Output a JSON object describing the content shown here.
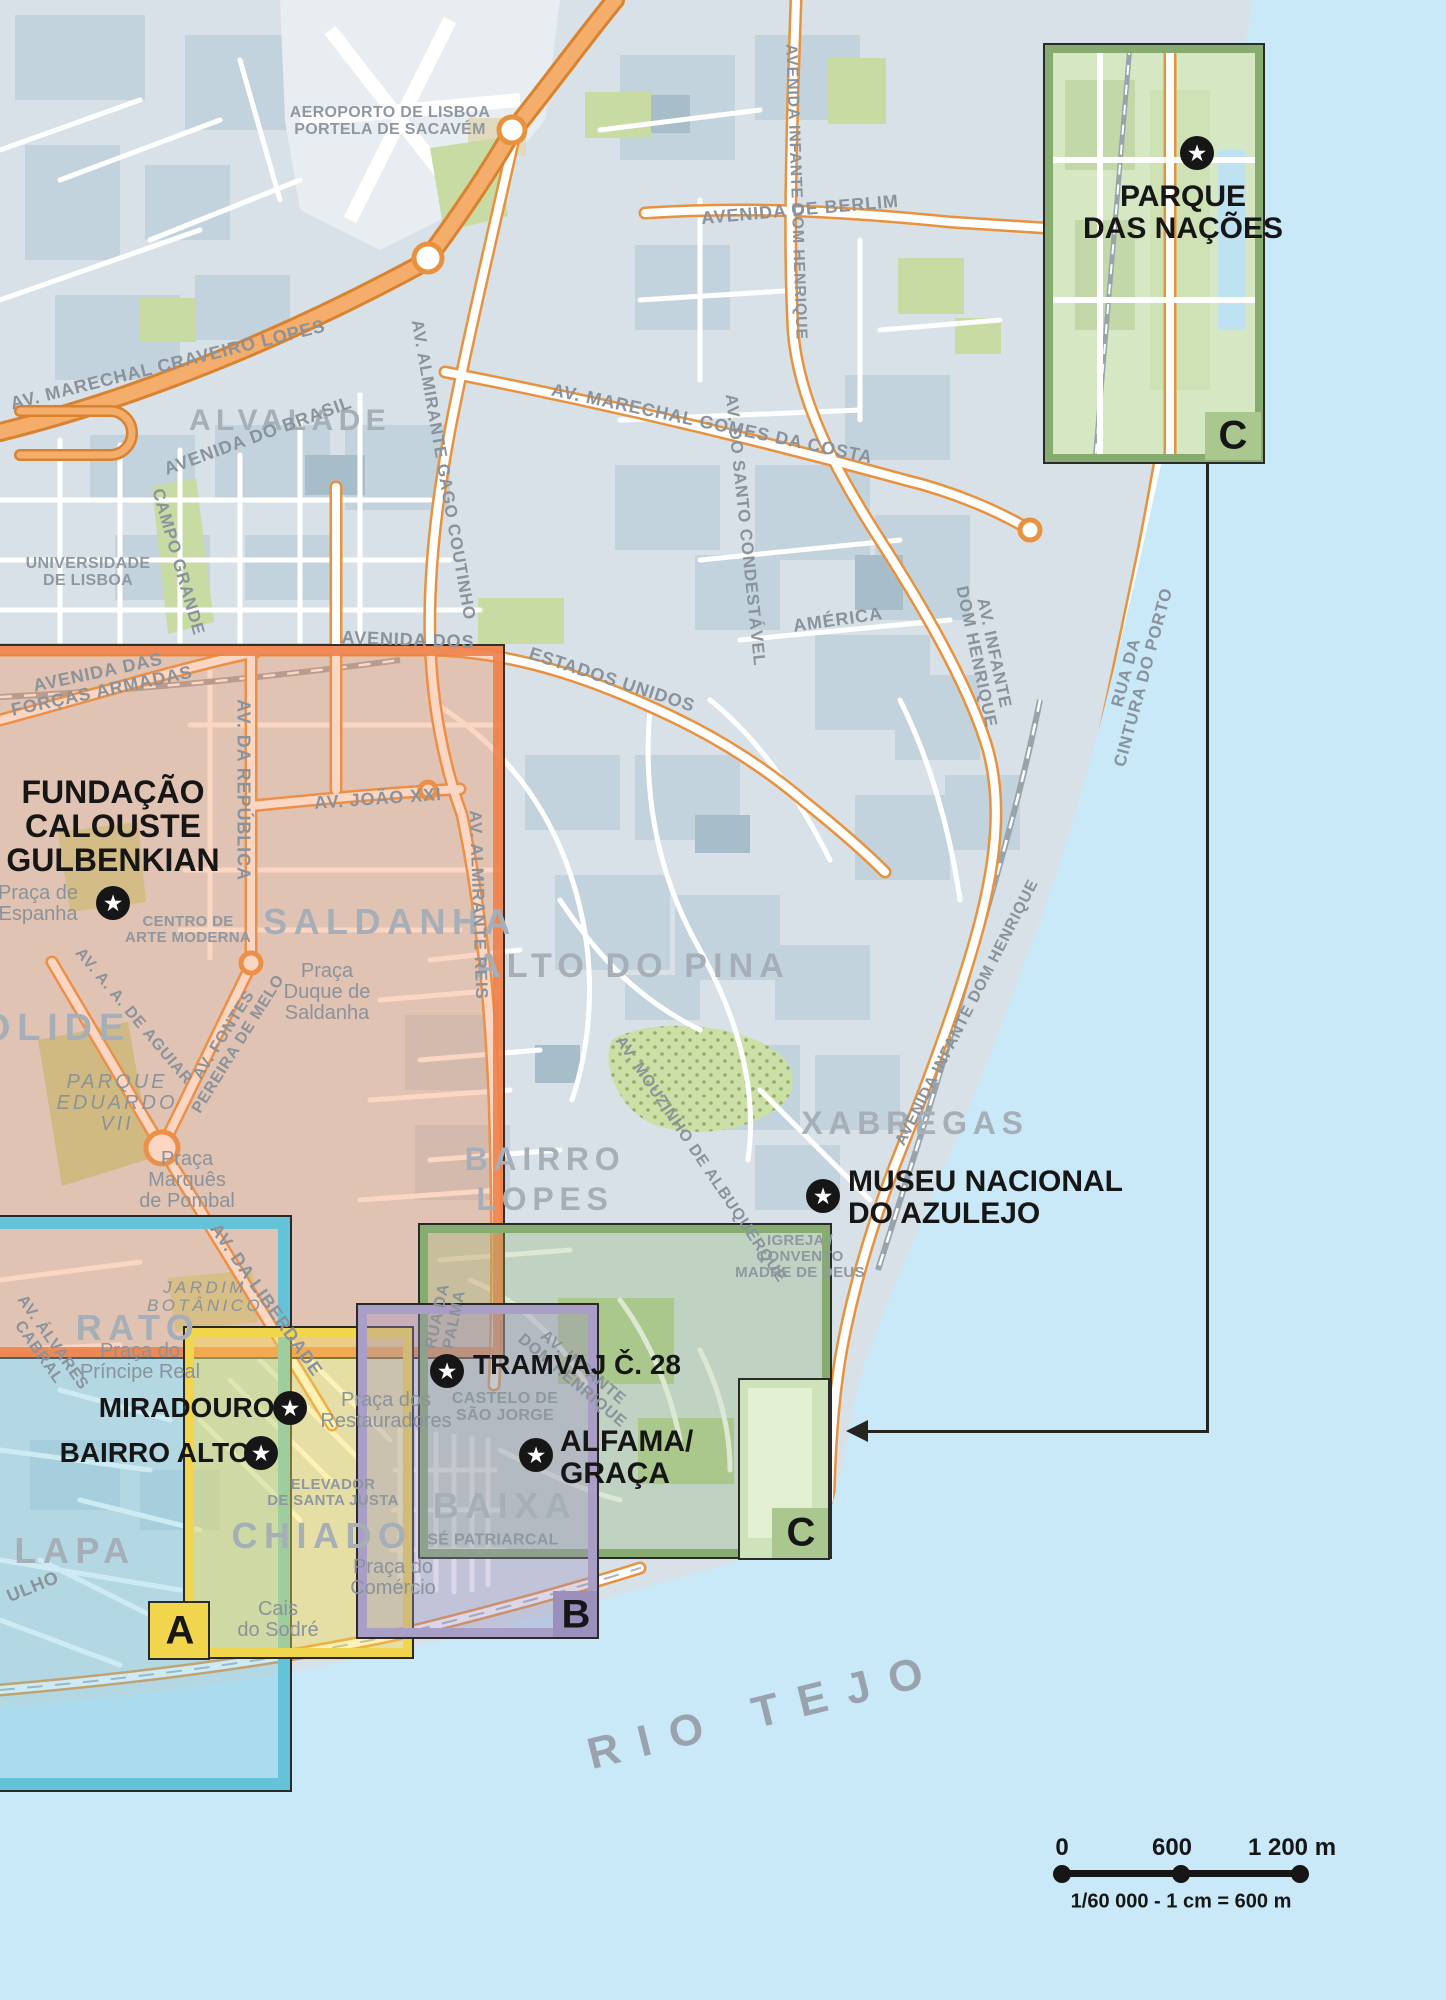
{
  "regions": {
    "alvalade": "ALVALADE",
    "saldanha": "SALDANHA",
    "alto_do_pina": "ALTO DO PINA",
    "xabregas": "XABREGAS",
    "bairro_lopes_1": "BAIRRO",
    "bairro_lopes_2": "LOPES",
    "rato": "RATO",
    "lapa": "LAPA",
    "chiado": "CHIADO",
    "baixa": "BAIXA",
    "campolide": "OLIDE",
    "rio_tejo": "RIO TEJO"
  },
  "streets": {
    "craveiro_lopes": "AV. MARECHAL CRAVEIRO LOPES",
    "berlim": "AVENIDA DE BERLIM",
    "infante_top": "AVENIDA INFANTE DOM HENRIQUE",
    "gago_coutinho": "AV. ALMIRANTE GAGO COUTINHO",
    "brasil": "AVENIDA DO BRASIL",
    "gomes_da_costa": "AV. MARECHAL GOMES DA COSTA",
    "estados_unidos_a": "AVENIDA DOS",
    "estados_unidos_b": "ESTADOS UNIDOS",
    "condestavel": "AV. DO SANTO CONDESTÁVEL",
    "america": "AMÉRICA",
    "infante_coast_a": "AV. INFANTE",
    "infante_coast_b": "DOM HENRIQUE",
    "cintura_a": "RUA DA",
    "cintura_b": "CINTURA DO PORTO",
    "republica": "AV. DA REPÚBLICA",
    "campo_grande": "CAMPO GRANDE",
    "forcas_a": "AVENIDA DAS",
    "forcas_b": "FORÇAS ARMADAS",
    "joao_xxi": "AV. JOÃO XXI",
    "almirante_reis": "AV. ALMIRANTE REIS",
    "mouzinho": "AV. MOUZINHO DE ALBUQUERQUE",
    "aguiar": "AV. A. A. DE AGUIAR",
    "fontes_a": "AV. FONTES",
    "fontes_b": "PEREIRA DE MELO",
    "liberdade": "AV. DA LIBERDADE",
    "alvares_a": "AV. ÁLVARES",
    "alvares_b": "CABRAL",
    "palma_a": "RUA DA",
    "palma_b": "PALMA",
    "infante_alfama_a": "AV. INFANTE",
    "infante_alfama_b": "DOM HENRIQUE",
    "infante_xabregas": "AVENIDA INFANTE DOM HENRIQUE",
    "julho": "ULHO"
  },
  "places": {
    "aeroporto_1": "AEROPORTO DE LISBOA",
    "aeroporto_2": "PORTELA DE SACAVÉM",
    "universidade_1": "UNIVERSIDADE",
    "universidade_2": "DE LISBOA",
    "espanha_1": "Praça de",
    "espanha_2": "Espanha",
    "centro_1": "CENTRO DE",
    "centro_2": "ARTE MODERNA",
    "duque_1": "Praça",
    "duque_2": "Duque de",
    "duque_3": "Saldanha",
    "marques_1": "Praça",
    "marques_2": "Marquês",
    "marques_3": "de Pombal",
    "eduardo_1": "PARQUE",
    "eduardo_2": "EDUARDO",
    "eduardo_3": "VII",
    "principe_1": "Praça do",
    "principe_2": "Príncipe Real",
    "jardim_1": "JARDIM",
    "jardim_2": "BOTÂNICO",
    "restauradores_1": "Praça dos",
    "restauradores_2": "Restauradores",
    "elevador_1": "ELEVADOR",
    "elevador_2": "DE SANTA JUSTA",
    "castelo_1": "CASTELO DE",
    "castelo_2": "SÃO JORGE",
    "se": "SÉ PATRIARCAL",
    "comercio_1": "Praça do",
    "comercio_2": "Comércio",
    "cais_1": "Cais",
    "cais_2": "do Sodré",
    "igreja_1": "IGREJA /",
    "igreja_2": "CONVENTO",
    "igreja_3": "MADRE DE DEUS"
  },
  "pois": {
    "gulbenkian_1": "FUNDAÇÃO",
    "gulbenkian_2": "CALOUSTE",
    "gulbenkian_3": "GULBENKIAN",
    "azulejo_1": "MUSEU NACIONAL",
    "azulejo_2": "DO AZULEJO",
    "tramvaj": "TRAMVAJ Č. 28",
    "miradouros": "MIRADOUROS",
    "bairro_alto": "BAIRRO ALTO",
    "alfama_1": "ALFAMA/",
    "alfama_2": "GRAÇA",
    "parque_1": "PARQUE",
    "parque_2": "DAS NAÇÕES"
  },
  "inset_labels": {
    "a": "A",
    "b": "B",
    "c_small": "C",
    "c_inset": "C"
  },
  "scale_bar": {
    "zero": "0",
    "mid": "600",
    "end": "1 200 m",
    "caption": "1/60 000 - 1 cm = 600 m"
  },
  "colors": {
    "water": "#c9e9f8",
    "land": "#d7e1e7",
    "block": "#c3d3dd",
    "park": "#c8dba3",
    "road_orange": "#f2a863",
    "box_orange": "#ee8256",
    "box_cyan": "#64c3d9",
    "box_yellow": "#f1d54c",
    "box_purple": "#a99ec6",
    "box_green": "#86ad6f",
    "star_bg": "#161616"
  }
}
